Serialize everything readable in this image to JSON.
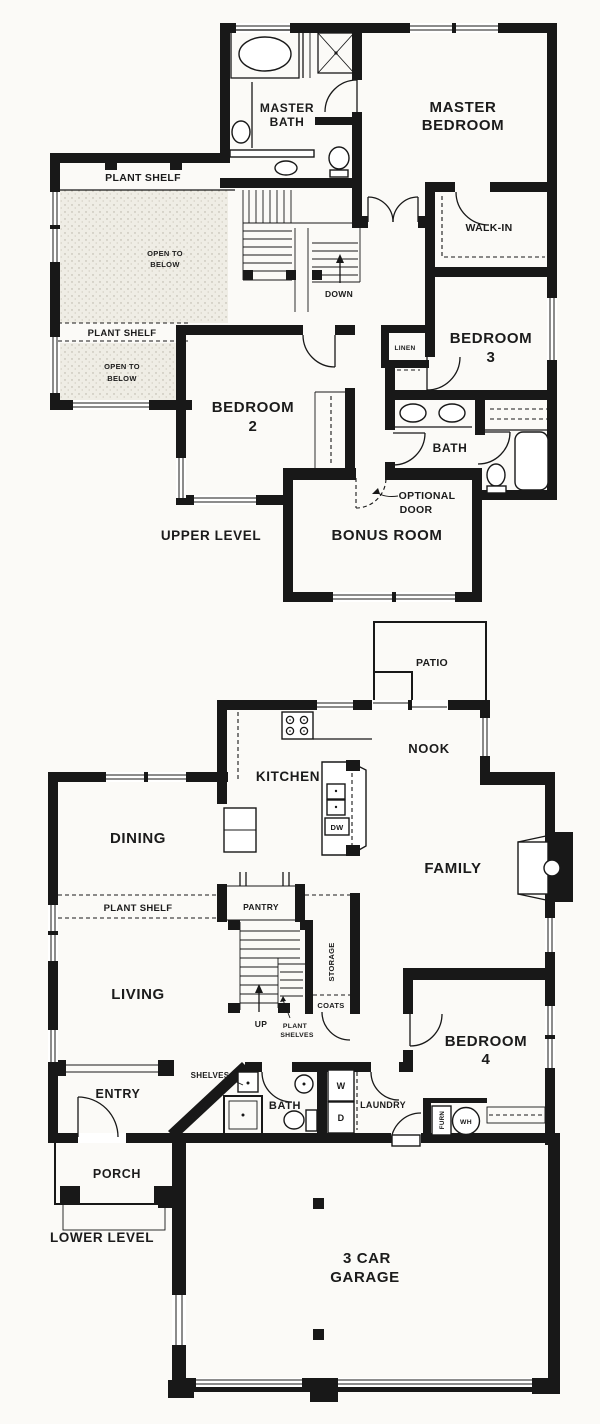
{
  "colors": {
    "ink": "#181818",
    "paper": "#fbfaf7",
    "stipple_bg": "#efede5",
    "stipple_dot": "#b5b0a3"
  },
  "upper": {
    "level_label": "UPPER LEVEL",
    "master_bath": [
      "MASTER",
      "BATH"
    ],
    "master_bedroom": [
      "MASTER",
      "BEDROOM"
    ],
    "walk_in": "WALK-IN",
    "bedroom3": [
      "BEDROOM",
      "3"
    ],
    "linen": "LINEN",
    "bedroom2": [
      "BEDROOM",
      "2"
    ],
    "bath": "BATH",
    "bonus_room": "BONUS ROOM",
    "optional_door": [
      "OPTIONAL",
      "DOOR"
    ],
    "plant_shelf_upper": "PLANT SHELF",
    "plant_shelf_lower": "PLANT SHELF",
    "open_to_below_1": [
      "OPEN TO",
      "BELOW"
    ],
    "open_to_below_2": [
      "OPEN TO",
      "BELOW"
    ],
    "down": "DOWN"
  },
  "lower": {
    "level_label": "LOWER LEVEL",
    "patio": "PATIO",
    "nook": "NOOK",
    "kitchen": "KITCHEN",
    "dishwasher": "DW",
    "dining": "DINING",
    "family": "FAMILY",
    "living": "LIVING",
    "plant_shelf": "PLANT SHELF",
    "pantry": "PANTRY",
    "storage": "STORAGE",
    "coats": "COATS",
    "up": "UP",
    "plant_shelves": [
      "PLANT",
      "SHELVES"
    ],
    "bedroom4": [
      "BEDROOM",
      "4"
    ],
    "entry": "ENTRY",
    "shelves": "SHELVES",
    "niche": "NICHE",
    "bath": "BATH",
    "laundry": "LAUNDRY",
    "washer": "W",
    "dryer": "D",
    "furnace": "FURN",
    "water_heater": "WH",
    "porch": "PORCH",
    "garage": [
      "3 CAR",
      "GARAGE"
    ]
  }
}
